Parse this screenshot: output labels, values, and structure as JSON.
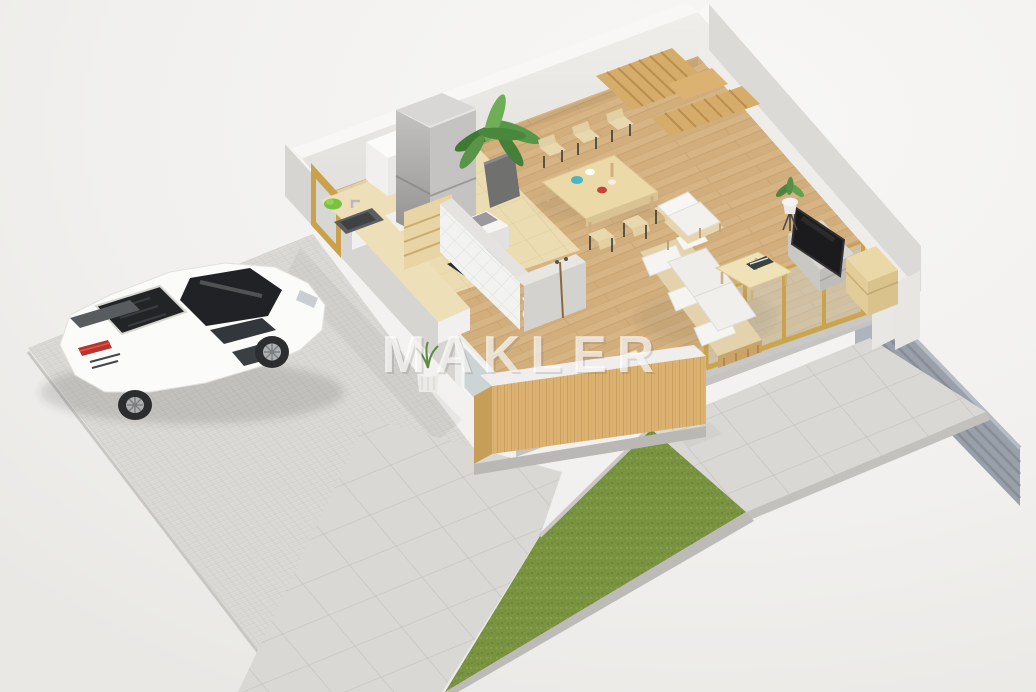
{
  "watermark": {
    "text": "MAKLER"
  },
  "scene": {
    "description": "Isometric 3D floor-plan rendering of a single-storey home interior with terrace, driveway, lawn, patio and a parked white sports car",
    "rooms": [
      "kitchen",
      "dining-area",
      "living-room",
      "bathroom",
      "terrace-deck",
      "staircase"
    ],
    "exterior_features": [
      "cobblestone-driveway",
      "tile-walkway",
      "lawn-strip",
      "tile-patio",
      "gray-privacy-fence",
      "white-sports-car",
      "wood-slat-terrace-wall",
      "glass-sliding-doors"
    ],
    "furniture": [
      "refrigerator",
      "kitchen-counter-with-sink",
      "cooktop",
      "kitchen-island",
      "white-cabinet",
      "dining-table",
      "dining-chairs-x6",
      "sofa",
      "armchair",
      "coffee-table-with-book",
      "tv-on-lowboard",
      "wood-sideboard",
      "toilet",
      "palm-plant",
      "tripod-plant",
      "floor-plant-pot",
      "winder-staircase"
    ]
  },
  "colors": {
    "background": "#f1f0ee",
    "wood_floor": "#d6b484",
    "kitchen_floor": "#ecdcb2",
    "slat_wood": "#dcb272",
    "lawn_green": "#7a9340",
    "patio_tile": "#d9d8d4",
    "cobblestone": "#dcdbd7",
    "wall_top_white": "#f8f7f5",
    "wall_gray": "#dcdad6",
    "fence_gray": "#99a0a9",
    "frame_gold": "#c9a24a",
    "car_body": "#fbfbfa",
    "watermark_white": "#ffffff"
  }
}
